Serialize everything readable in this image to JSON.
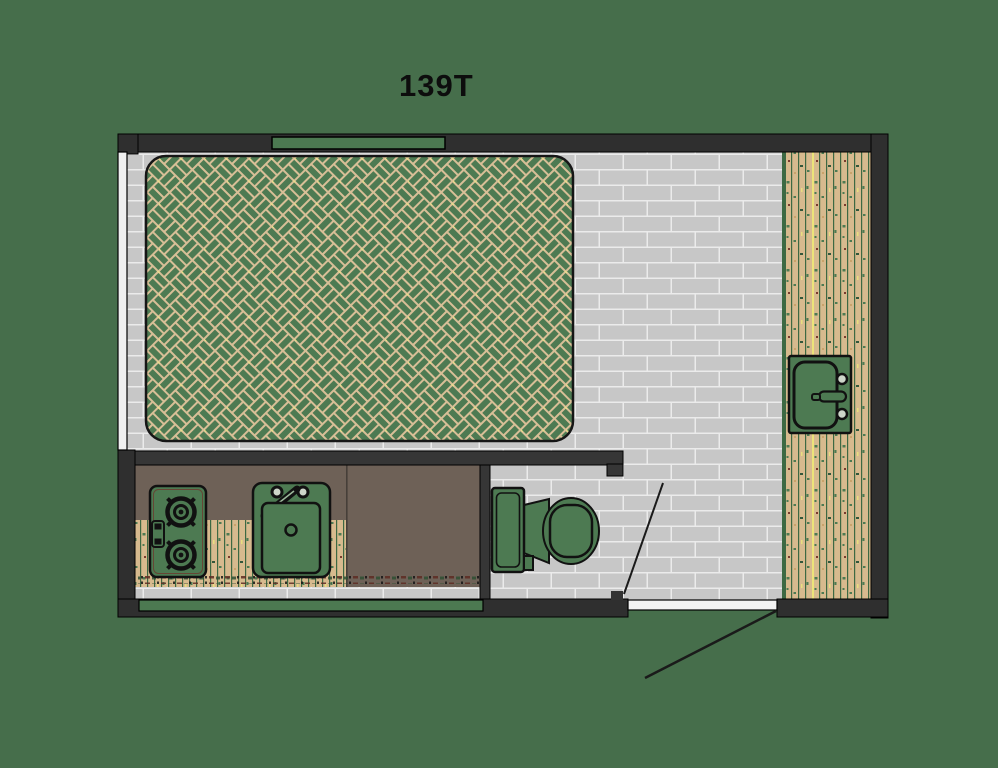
{
  "title": "139T",
  "colors": {
    "background": "#466E4B",
    "wall": "#2F2F2F",
    "floor_tile": "#C7C7C7",
    "floor_grout": "#EBEBEB",
    "wood_plank": "#D7BA8E",
    "wood_gap": "#3D6943",
    "wood_accent_yellow": "#ECE47A",
    "counter_brown": "#6E6157",
    "fixture_green": "#4D7A52",
    "bed_grout_tan": "#D8BF97",
    "window_green": "#4C7951",
    "left_window_white": "#F0F0F0",
    "outline_black": "#111111"
  },
  "floorplan": {
    "model_label": "139T",
    "areas": [
      "sleeping-area",
      "kitchen",
      "bathroom",
      "entry"
    ],
    "fixtures": [
      "bed",
      "stove-cooktop",
      "kitchen-sink",
      "toilet",
      "vanity-sink",
      "entry-door"
    ],
    "windows": [
      "top-window",
      "left-window",
      "bottom-window"
    ],
    "floors": [
      "tile-floor",
      "wood-floor"
    ]
  }
}
